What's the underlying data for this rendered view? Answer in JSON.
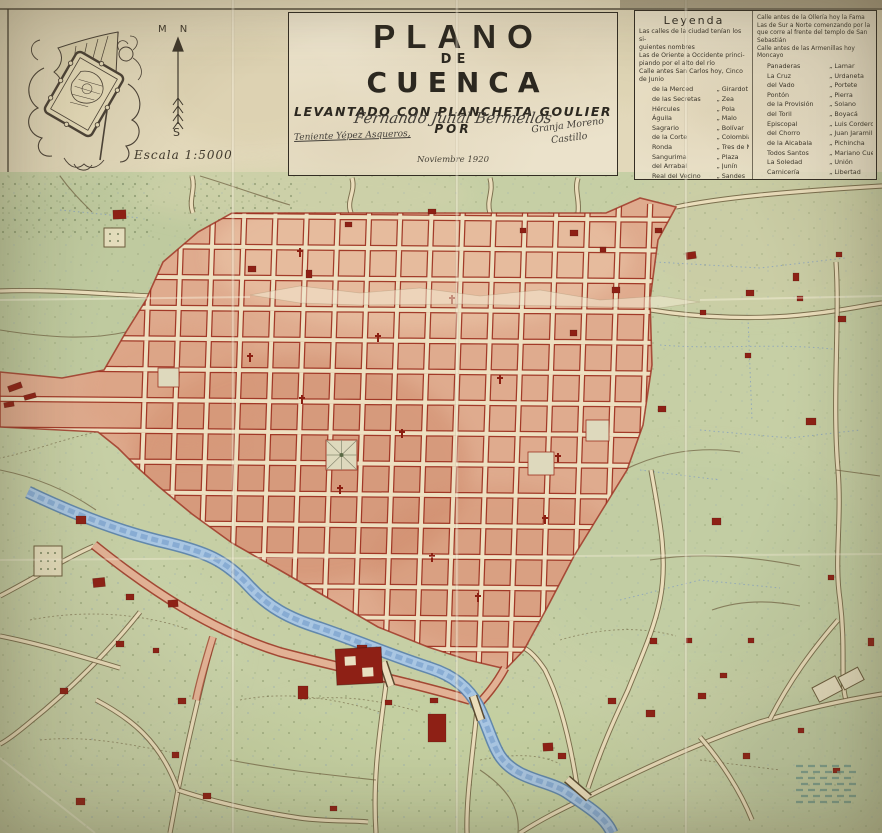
{
  "palette": {
    "paper": "#e2d8ba",
    "terrain_green": "#c6cfa5",
    "city_block": "#dfab8e",
    "block_outline": "#9c3020",
    "street_cream": "#eedfc0",
    "river_blue": "#a9c6e2",
    "building_red": "#8e2015",
    "ink": "#2f2a20"
  },
  "cartouche": {
    "compass_top": "M N",
    "compass_bottom": "S",
    "scale": "Escala 1:5000"
  },
  "title_block": {
    "title_1": "PLANO",
    "title_2": "DE",
    "title_3": "CUENCA",
    "subtitle": "LEVANTADO CON PLANCHETA GOULIER",
    "por": "POR",
    "signature_center": "Fernando Julial Bermellos",
    "signature_left": "Teniente Yépez Asqueros,",
    "signature_right_1": "Granja Moreno",
    "signature_right_2": "Castillo",
    "date": "Noviembre 1920"
  },
  "legend": {
    "title": "Leyenda",
    "sep": "„",
    "intro": [
      "Las calles de la ciudad tenían los si-",
      "guientes nombres"
    ],
    "left_head": [
      "Las de Oriente a Occidente princi-",
      "piando por el alto del río",
      "Calle antes San Carlos hoy, Cinco de Junio"
    ],
    "left_pairs": [
      [
        "de la Merced",
        "Girardot"
      ],
      [
        "de las Secretas",
        "Zea"
      ],
      [
        "Hércules",
        "Pola"
      ],
      [
        "Águila",
        "Malo"
      ],
      [
        "Sagrario",
        "Bolívar"
      ],
      [
        "de la Corte",
        "Colombia"
      ],
      [
        "Ronda",
        "Tres de Noviembre"
      ],
      [
        "Sangurima",
        "Plaza"
      ],
      [
        "del Arrabal",
        "Junín"
      ],
      [
        "Real del Vecino",
        "Sandes"
      ]
    ],
    "right_head": [
      "Calle antes de la Ollería hoy la Fama",
      "Las de Sur a Norte comenzando por la",
      "que corre al frente del templo de San Sebastián",
      "Calle antes de las Armenillas hoy Moncayo"
    ],
    "right_pairs": [
      [
        "Panaderas",
        "Lamar"
      ],
      [
        "La Cruz",
        "Urdaneta"
      ],
      [
        "del Vado",
        "Portete"
      ],
      [
        "Pontón",
        "Pierra"
      ],
      [
        "de la Provisión",
        "Solano"
      ],
      [
        "del Toril",
        "Boyacá"
      ],
      [
        "Episcopal",
        "Luis Cordero"
      ],
      [
        "del Chorro",
        "Juan Jaramillo"
      ],
      [
        "de la Alcabala",
        "Pichincha"
      ],
      [
        "Todos Santos",
        "Mariano Cueva"
      ],
      [
        "La Soledad",
        "Unión"
      ],
      [
        "Carnicería",
        "Libertad"
      ]
    ]
  }
}
